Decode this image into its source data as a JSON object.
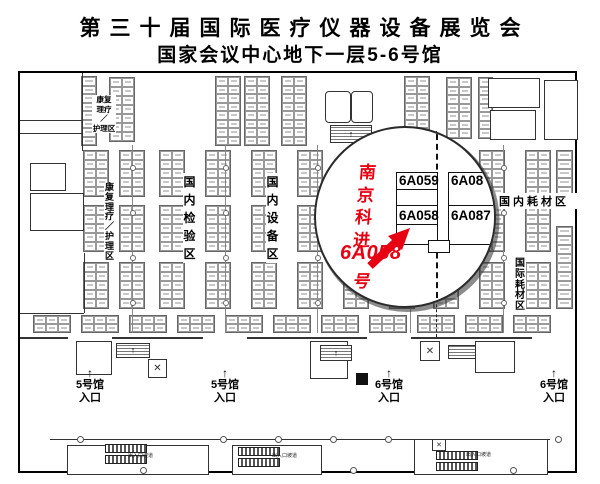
{
  "title": {
    "line1": "第三十届国际医疗仪器设备展览会",
    "line2": "国家会议中心地下一层5-6号馆"
  },
  "colors": {
    "accent_red": "#e60012",
    "line": "#333333"
  },
  "magnifier": {
    "company": "南京科进",
    "highlight_booth": "6A058",
    "highlight_suffix": "号",
    "booth_tl": "6A059",
    "booth_tr": "6A08",
    "booth_bl": "6A058",
    "booth_br": "6A087"
  },
  "zones": [
    {
      "id": "rehab-nursing-top",
      "mode": "block",
      "x": 72,
      "y": 22,
      "w": 24,
      "fs": 7.5,
      "lh": 9.5,
      "lines": [
        "康复",
        "理疗",
        "／",
        "护理区"
      ]
    },
    {
      "id": "rehab-nursing-left",
      "mode": "v",
      "x": 84,
      "y": 110,
      "w": 11,
      "fs": 9,
      "lh": 9.8,
      "text": "康复理疗／护理区"
    },
    {
      "id": "domestic-testing",
      "mode": "v",
      "x": 163,
      "y": 100,
      "w": 13,
      "fs": 12,
      "lh": 18,
      "text": "国内检验区"
    },
    {
      "id": "domestic-equipment",
      "mode": "v",
      "x": 246,
      "y": 100,
      "w": 13,
      "fs": 12,
      "lh": 18,
      "text": "国内设备区"
    },
    {
      "id": "domestic-consumables",
      "mode": "h",
      "x": 468,
      "y": 120,
      "w": 92,
      "fs": 11,
      "ls": 3,
      "text": "国内耗材区"
    },
    {
      "id": "intl-consumables",
      "mode": "v",
      "x": 494,
      "y": 186,
      "w": 12,
      "fs": 10,
      "lh": 10.8,
      "text": "国际耗材区"
    }
  ],
  "entrances": [
    {
      "id": "hall5-entrance-1",
      "x": 47,
      "y": 294,
      "arrow": "↑",
      "hall": "5号馆",
      "entry": "入口"
    },
    {
      "id": "hall5-entrance-2",
      "x": 182,
      "y": 294,
      "arrow": "↑",
      "hall": "5号馆",
      "entry": "入口"
    },
    {
      "id": "hall6-entrance-1",
      "x": 346,
      "y": 294,
      "arrow": "↑",
      "hall": "6号馆",
      "entry": "入口"
    },
    {
      "id": "hall6-entrance-2",
      "x": 511,
      "y": 294,
      "arrow": "↑",
      "hall": "6号馆",
      "entry": "入口"
    }
  ],
  "ramps": {
    "label": "出入口坡道",
    "positions": [
      {
        "x": 108,
        "y": 379
      },
      {
        "x": 252,
        "y": 379
      },
      {
        "x": 446,
        "y": 378
      }
    ]
  },
  "map_geometry": {
    "clusters": [
      {
        "x": 62,
        "y": 4,
        "cols": 1,
        "rows": 8,
        "cw": 14,
        "ch": 8.5
      },
      {
        "x": 90,
        "y": 5,
        "cols": 2,
        "rows": 7,
        "cw": 12,
        "ch": 9
      },
      {
        "x": 196,
        "y": 4,
        "cols": 2,
        "rows": 8,
        "cw": 12,
        "ch": 8.5
      },
      {
        "x": 225,
        "y": 4,
        "cols": 2,
        "rows": 8,
        "cw": 12,
        "ch": 8.5
      },
      {
        "x": 262,
        "y": 4,
        "cols": 2,
        "rows": 8,
        "cw": 12,
        "ch": 8.5
      },
      {
        "x": 385,
        "y": 4,
        "cols": 2,
        "rows": 8,
        "cw": 12,
        "ch": 8.5
      },
      {
        "x": 427,
        "y": 5,
        "cols": 2,
        "rows": 7,
        "cw": 12,
        "ch": 8.5
      },
      {
        "x": 459,
        "y": 5,
        "cols": 1,
        "rows": 7,
        "cw": 13,
        "ch": 8.5
      },
      {
        "x": 537,
        "y": 78,
        "cols": 1,
        "rows": 6,
        "cw": 15,
        "ch": 9
      },
      {
        "x": 537,
        "y": 154,
        "cols": 1,
        "rows": 9,
        "cw": 15,
        "ch": 9
      }
    ],
    "grids": [
      {
        "y": 78,
        "rows": 5,
        "cols": 2,
        "cw": 12,
        "ch": 9,
        "xs": [
          64,
          100,
          140,
          186,
          232,
          278,
          324,
          370,
          414,
          460,
          506
        ]
      },
      {
        "y": 133,
        "rows": 5,
        "cols": 2,
        "cw": 12,
        "ch": 9,
        "xs": [
          64,
          100,
          140,
          186,
          232,
          278,
          324,
          370,
          414,
          460,
          506
        ]
      },
      {
        "y": 190,
        "rows": 5,
        "cols": 2,
        "cw": 12,
        "ch": 9,
        "xs": [
          64,
          100,
          140,
          186,
          232,
          278,
          324,
          370,
          414,
          460,
          506
        ]
      },
      {
        "y": 243,
        "rows": 2,
        "cols": 3,
        "cw": 12,
        "ch": 8,
        "xs": [
          14,
          62,
          110,
          158,
          206,
          254,
          302,
          350,
          398,
          446,
          494
        ]
      }
    ],
    "aisles": [
      {
        "x": 112,
        "y": 72,
        "h": 188
      },
      {
        "x": 205,
        "y": 72,
        "h": 188
      },
      {
        "x": 297,
        "y": 72,
        "h": 188
      },
      {
        "x": 390,
        "y": 72,
        "h": 188
      },
      {
        "x": 483,
        "y": 72,
        "h": 188
      }
    ],
    "structures": [
      {
        "t": "vline",
        "x": 62,
        "y": 0,
        "l": 78
      },
      {
        "t": "hline",
        "x": 0,
        "y": 47,
        "l": 62
      },
      {
        "t": "hline",
        "x": 0,
        "y": 60,
        "l": 62
      },
      {
        "t": "rect",
        "x": 10,
        "y": 90,
        "w": 34,
        "h": 26
      },
      {
        "t": "rect",
        "x": 10,
        "y": 120,
        "w": 52,
        "h": 36
      },
      {
        "t": "vline",
        "x": 64,
        "y": 180,
        "l": 60
      },
      {
        "t": "hline",
        "x": 0,
        "y": 240,
        "l": 64
      },
      {
        "t": "rectr",
        "x": 305,
        "y": 18,
        "w": 24,
        "h": 30
      },
      {
        "t": "rectr",
        "x": 331,
        "y": 18,
        "w": 20,
        "h": 30
      },
      {
        "t": "hatch",
        "x": 310,
        "y": 52,
        "w": 40,
        "h": 16,
        "arrow": true
      },
      {
        "t": "rect",
        "x": 468,
        "y": 5,
        "w": 50,
        "h": 28
      },
      {
        "t": "rect",
        "x": 470,
        "y": 37,
        "w": 44,
        "h": 28
      },
      {
        "t": "rect",
        "x": 524,
        "y": 7,
        "w": 32,
        "h": 58
      },
      {
        "t": "dashv",
        "x": 416,
        "y": 58,
        "l": 206
      },
      {
        "t": "hline2",
        "x": 0,
        "y": 264,
        "l": 48
      },
      {
        "t": "hline2",
        "x": 92,
        "y": 264,
        "l": 91
      },
      {
        "t": "hline2",
        "x": 227,
        "y": 264,
        "l": 120
      },
      {
        "t": "hline2",
        "x": 391,
        "y": 264,
        "l": 121
      },
      {
        "t": "rect",
        "x": 56,
        "y": 268,
        "w": 34,
        "h": 32
      },
      {
        "t": "hatch",
        "x": 96,
        "y": 270,
        "w": 32,
        "h": 13,
        "arrow": true
      },
      {
        "t": "xbox",
        "x": 128,
        "y": 286,
        "w": 17,
        "h": 17
      },
      {
        "t": "rect",
        "x": 290,
        "y": 268,
        "w": 36,
        "h": 36
      },
      {
        "t": "hatch",
        "x": 300,
        "y": 272,
        "w": 30,
        "h": 14,
        "arrow": true
      },
      {
        "t": "blackbox",
        "x": 336,
        "y": 300,
        "w": 12,
        "h": 12
      },
      {
        "t": "xbox",
        "x": 400,
        "y": 268,
        "w": 18,
        "h": 18
      },
      {
        "t": "hatch",
        "x": 428,
        "y": 272,
        "w": 26,
        "h": 12,
        "arrow": false
      },
      {
        "t": "rect",
        "x": 455,
        "y": 268,
        "w": 38,
        "h": 30
      },
      {
        "t": "hline",
        "x": 30,
        "y": 366,
        "l": 500
      },
      {
        "t": "rect",
        "x": 47,
        "y": 372,
        "w": 140,
        "h": 28
      },
      {
        "t": "bars",
        "x": 85,
        "y": 371
      },
      {
        "t": "rect",
        "x": 212,
        "y": 372,
        "w": 88,
        "h": 28
      },
      {
        "t": "bars",
        "x": 218,
        "y": 374
      },
      {
        "t": "rect",
        "x": 394,
        "y": 366,
        "w": 132,
        "h": 34
      },
      {
        "t": "sqx",
        "x": 412,
        "y": 366,
        "w": 12,
        "h": 10
      },
      {
        "t": "bars",
        "x": 416,
        "y": 378
      },
      {
        "t": "col",
        "x": 57,
        "y": 363
      },
      {
        "t": "col",
        "x": 200,
        "y": 363
      },
      {
        "t": "col",
        "x": 255,
        "y": 363
      },
      {
        "t": "col",
        "x": 310,
        "y": 363
      },
      {
        "t": "col",
        "x": 365,
        "y": 363
      },
      {
        "t": "col",
        "x": 535,
        "y": 363
      },
      {
        "t": "col",
        "x": 120,
        "y": 394
      },
      {
        "t": "col",
        "x": 330,
        "y": 394
      },
      {
        "t": "col",
        "x": 490,
        "y": 394
      }
    ]
  }
}
